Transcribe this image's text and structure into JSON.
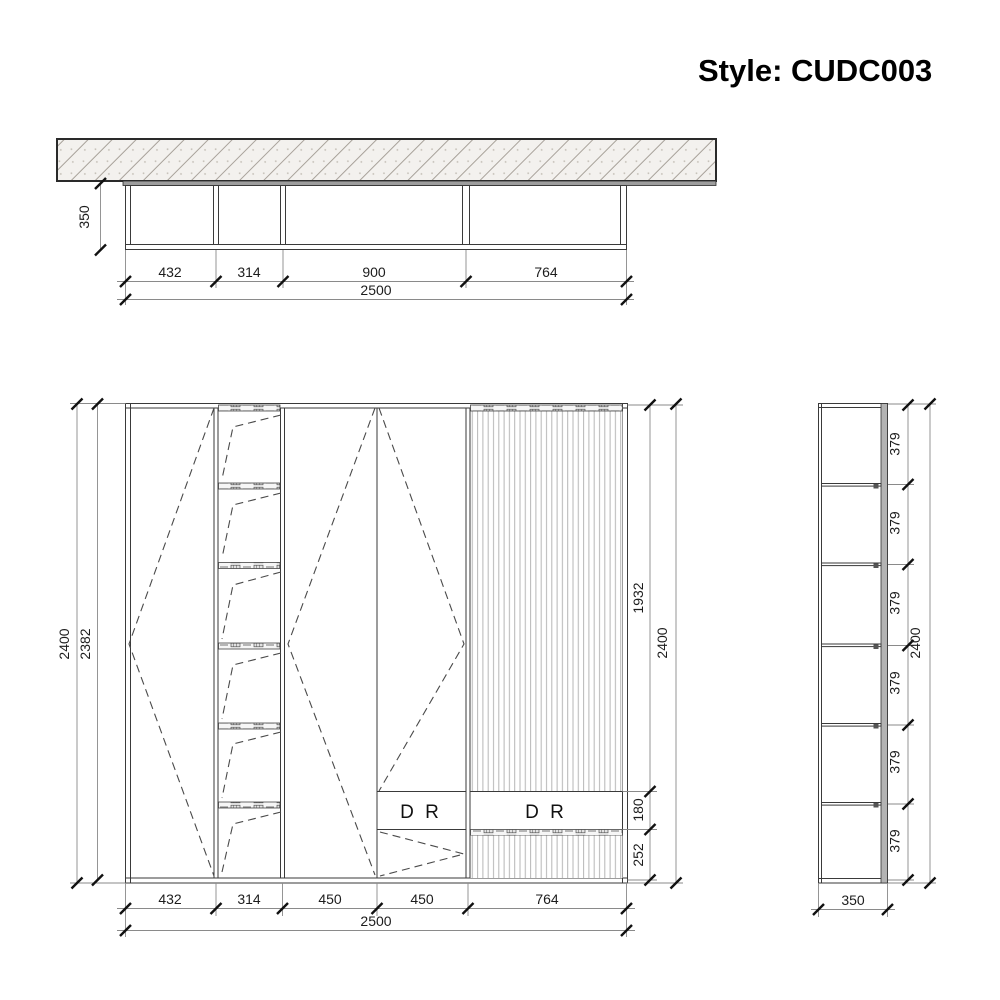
{
  "title": {
    "text": "Style: CUDC003"
  },
  "plan_view": {
    "depth": "350",
    "segments": [
      "432",
      "314",
      "900",
      "764"
    ],
    "total": "2500"
  },
  "front_view": {
    "left_dims": [
      "2400",
      "2382"
    ],
    "right_dims": [
      "1932",
      "180",
      "252"
    ],
    "right_total": "2400",
    "bottom_segments": [
      "432",
      "314",
      "450",
      "450",
      "764"
    ],
    "bottom_total": "2500",
    "drawers": [
      "D R",
      "D R"
    ]
  },
  "side_view": {
    "cells": [
      "379",
      "379",
      "379",
      "379",
      "379",
      "379"
    ],
    "total": "2400",
    "depth": "350"
  }
}
